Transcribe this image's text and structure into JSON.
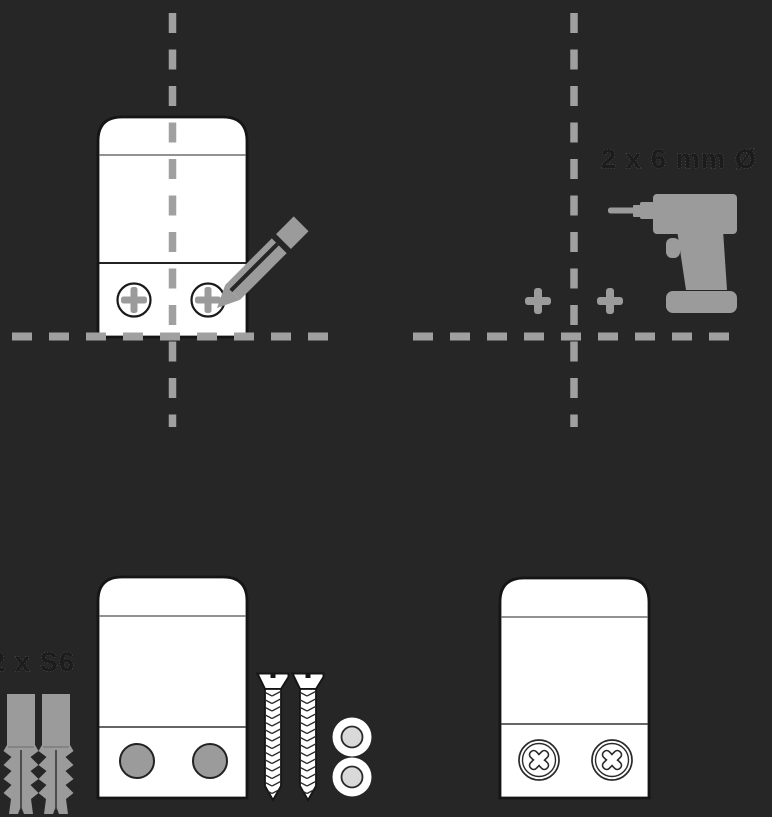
{
  "title": "wall-mounting-instruction-diagram",
  "background": "#262626",
  "colors": {
    "accent_gray": "#9b9b9b",
    "dashed_line_gray": "#a0a0a0",
    "device_fill": "#ffffff",
    "outline_dark": "#1a1a1a",
    "label_text": "#1c1c1c",
    "washer_inner": "#d9d9d9"
  },
  "panels": {
    "mark_positions": {
      "icons": [
        "device-outline",
        "crosshair-dashed-lines",
        "screw-position-cross",
        "pencil-icon"
      ]
    },
    "drill_holes": {
      "drill_spec_label": "2 x 6 mm Ø",
      "icons": [
        "crosshair-dashed-lines",
        "drill-icon",
        "drill-point-cross"
      ]
    },
    "insert_anchors": {
      "anchor_spec_label": "2 x S6",
      "icons": [
        "wall-plug-icon",
        "device-outline",
        "mounting-hole",
        "screw-icon",
        "washer-icon"
      ]
    },
    "mounted": {
      "icons": [
        "device-outline",
        "screw-head-icon"
      ]
    }
  }
}
